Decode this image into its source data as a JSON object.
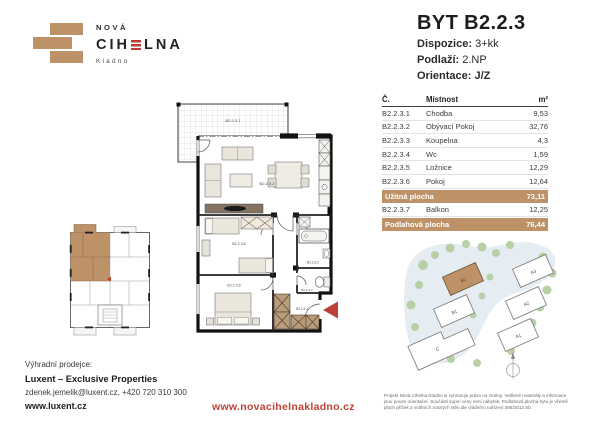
{
  "logo": {
    "top": "NOVÁ",
    "name_pre": "CIH",
    "name_post": "LNA",
    "city": "Kladno"
  },
  "header": {
    "title": "BYT B2.2.3",
    "specs": [
      {
        "label": "Dispozice:",
        "value": "3+kk"
      },
      {
        "label": "Podlaží:",
        "value": "2.NP"
      },
      {
        "label": "Orientace:",
        "value": "J/Z"
      }
    ]
  },
  "table": {
    "headers": {
      "no": "Č.",
      "room": "Místnost",
      "area": "m²"
    },
    "rows": [
      {
        "no": "B2.2.3.1",
        "room": "Chodba",
        "area": "9,53"
      },
      {
        "no": "B2.2.3.2",
        "room": "Obývací Pokoj",
        "area": "32,76"
      },
      {
        "no": "B2.2.3.3",
        "room": "Koupelna",
        "area": "4,3"
      },
      {
        "no": "B2.2.3.4",
        "room": "Wc",
        "area": "1,59"
      },
      {
        "no": "B2.2.3.5",
        "room": "Ložnice",
        "area": "12,29"
      },
      {
        "no": "B2.2.3.6",
        "room": "Pokoj",
        "area": "12,64"
      }
    ],
    "usable": {
      "label": "Užitná plocha",
      "value": "73,11"
    },
    "balcony_row": {
      "no": "B2.2.3.7",
      "room": "Balkon",
      "area": "12,25"
    },
    "floor": {
      "label": "Podlahová plocha",
      "value": "76,44"
    }
  },
  "floorplan": {
    "labels": {
      "balcony": "B2.2.3.7",
      "living": "B2.2.3.2",
      "room6": "B2.2.3.6",
      "bedroom": "B2.2.3.5",
      "bath": "B2.2.3.3",
      "wc": "B2.2.3.4",
      "hall": "B2.2.3.1"
    }
  },
  "siteplan": {
    "buildings": [
      {
        "label": "B2"
      },
      {
        "label": "B1"
      },
      {
        "label": "A3"
      },
      {
        "label": "A2"
      },
      {
        "label": "A1"
      },
      {
        "label": "C"
      }
    ],
    "highlighted": "B2"
  },
  "footer": {
    "seller_label": "Výhradní prodejce:",
    "seller_name": "Luxent – Exclusive Properties",
    "seller_contact": "zdenek.jemelik@luxent.cz, +420 720 310 300",
    "seller_web": "www.luxent.cz",
    "project_web": "www.novacihelnakladno.cz",
    "disclaimer": "Projekt Nová Cihelna Kladno si vyhrazuje právo na změny. Veškeré materiály a informace jsou pouze orientační. Součástí kupní ceny není nábytek. Podlahová plocha bytu je včetně ploch příček a vnitřních nosných stěn dle vládního nařízení 366/2013 Sb."
  },
  "colors": {
    "brick": "#BE9268",
    "accent_red": "#BF4136",
    "text": "#232323"
  }
}
